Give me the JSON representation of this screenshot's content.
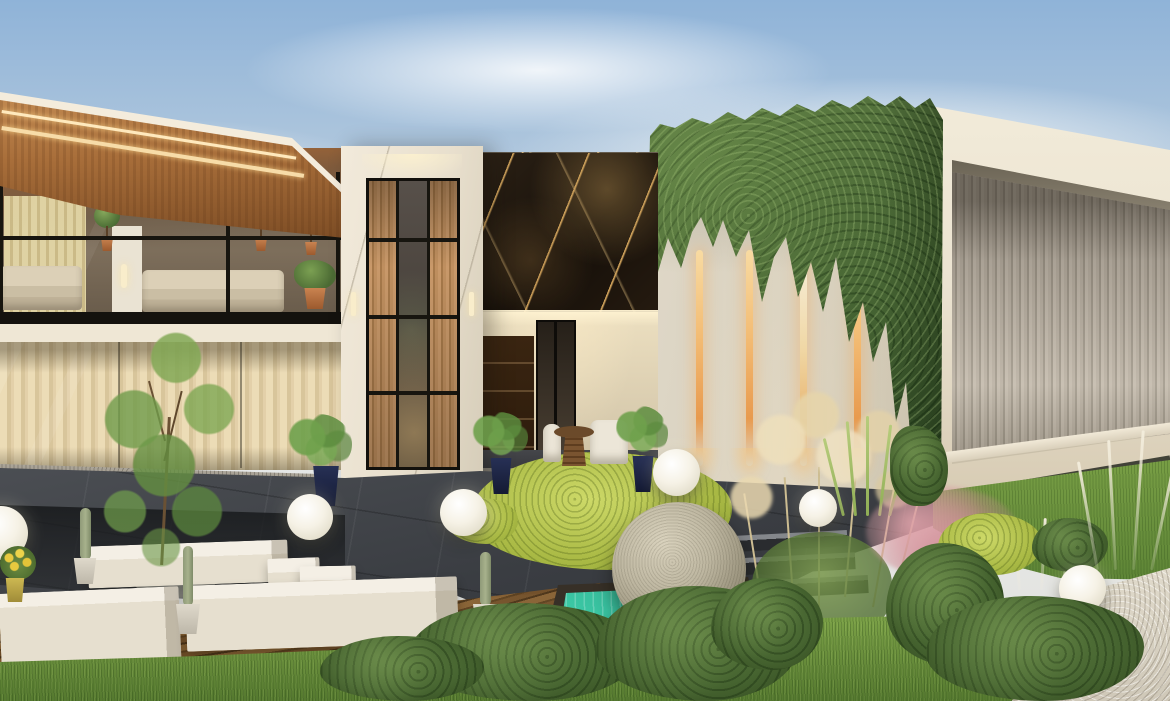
{
  "meta": {
    "title": "Modern villa exterior - architectural 3D rendering",
    "description": "Dusk rendering of a modern luxury villa: left pavilion with copper soffit and glass lounge, white marble entry tower with wood-slat window, black gold-veined marble feature wall, ivy-draped wing with four amber light slits, cream portal pavilion with ribbed recessed wall, and a landscaped garden with sunken white benches, sphere lamps, a granite sphere over a turquoise reflecting pool, pampas and pink grasses, bushes, lawn and gravel path."
  },
  "palette": {
    "sky_top": "#8FB3D8",
    "sky_haze": "#E7E8E6",
    "copper_roof": "#C68E55",
    "copper_dark": "#7C4C24",
    "fascia": "#F4ECDC",
    "glass_interior": "#7D6E5B",
    "curtain_light": "#E3D6A6",
    "curtain_shade": "#CEBD89",
    "mullion": "#17150F",
    "sofa": "#CABEA4",
    "tower_marble": "#E8DFCD",
    "wood_slat": "#C9996A",
    "wood_slat_dark": "#A6794A",
    "marble_black": "#150F09",
    "marble_vein": "#CDA05A",
    "porch_wall": "#D8CBAE",
    "door_wood": "#2C1B0C",
    "pot_navy": "#141A33",
    "pot_terracotta": "#C98350",
    "ivy_wall": "#D7CFBD",
    "ivy_green": "#57753F",
    "ivy_shadow": "#2E4724",
    "light_slit": "#F3BC74",
    "right_frame": "#EBE3D1",
    "ribbed_wall": "#C3BAAD",
    "slate_paving": "#3A3D42",
    "granite_step": "#968F82",
    "lawn": "#7DA348",
    "grass_dark": "#466430",
    "chartreuse": "#AABA45",
    "bench_white": "#E6DFCF",
    "stone_sphere": "#BDB6A0",
    "pool_teal": "#3FD0AC",
    "lamp_white": "#F6F2E6",
    "gravel": "#CFC8B8",
    "pampas": "#CDBD92",
    "pink_grass": "#BE7882",
    "deck_wood": "#76522A",
    "cactus": "#A7B18C",
    "pouf_gray": "#7B7B75",
    "tree_green": "#6F9B4A"
  },
  "scene": {
    "buildings": [
      {
        "name": "left-pavilion",
        "features": [
          "angled copper soffit roof",
          "two LED strip lights on fascia",
          "upper glass lounge with beige sofas and topiary plants",
          "pale striped curtain ground floor",
          "granite entry steps"
        ]
      },
      {
        "name": "entry-tower",
        "features": [
          "white marble frame",
          "cove-lit recessed header",
          "tall window with black mullion grid",
          "wood slat side panes",
          "two glowing wall sconces"
        ]
      },
      {
        "name": "marble-feature-wall",
        "features": [
          "black marble with gold veining"
        ]
      },
      {
        "name": "porch",
        "features": [
          "warm recessed lighting",
          "dark wood shelving wall",
          "black-framed glass door",
          "white chairs and round rattan table",
          "plants in navy pots"
        ]
      },
      {
        "name": "ivy-wing",
        "features": [
          "ivy cascading over parapet in triangular swags",
          "four vertical amber light slits",
          "sphere lamps at base"
        ]
      },
      {
        "name": "right-pavilion",
        "features": [
          "deep cream portal frame",
          "vertically ribbed recessed wall",
          "shadowed base over lawn"
        ]
      }
    ],
    "garden": [
      "sunken lounge with white stone benches and cube stools",
      "slender tree",
      "three potted cacti",
      "gray pouf",
      "glowing sphere lamps",
      "granite sphere sculpture",
      "turquoise reflecting pool with dark stone rim",
      "chartreuse ground cover",
      "rounded boxwood bushes",
      "pampas grass plumes",
      "pink muhly grass",
      "white feather grass",
      "front lawn",
      "gravel path",
      "timber deck strips",
      "yellow potted flowers"
    ],
    "lighting": [
      "warm LED fascia strips",
      "amber wall slit lights",
      "seven glowing sphere lamps",
      "sconce and cove lights"
    ],
    "counts": {
      "sphere_lamps": 7,
      "light_slits": 4,
      "benches_and_stools": 5,
      "window_rows": 4,
      "window_columns": 3
    }
  }
}
